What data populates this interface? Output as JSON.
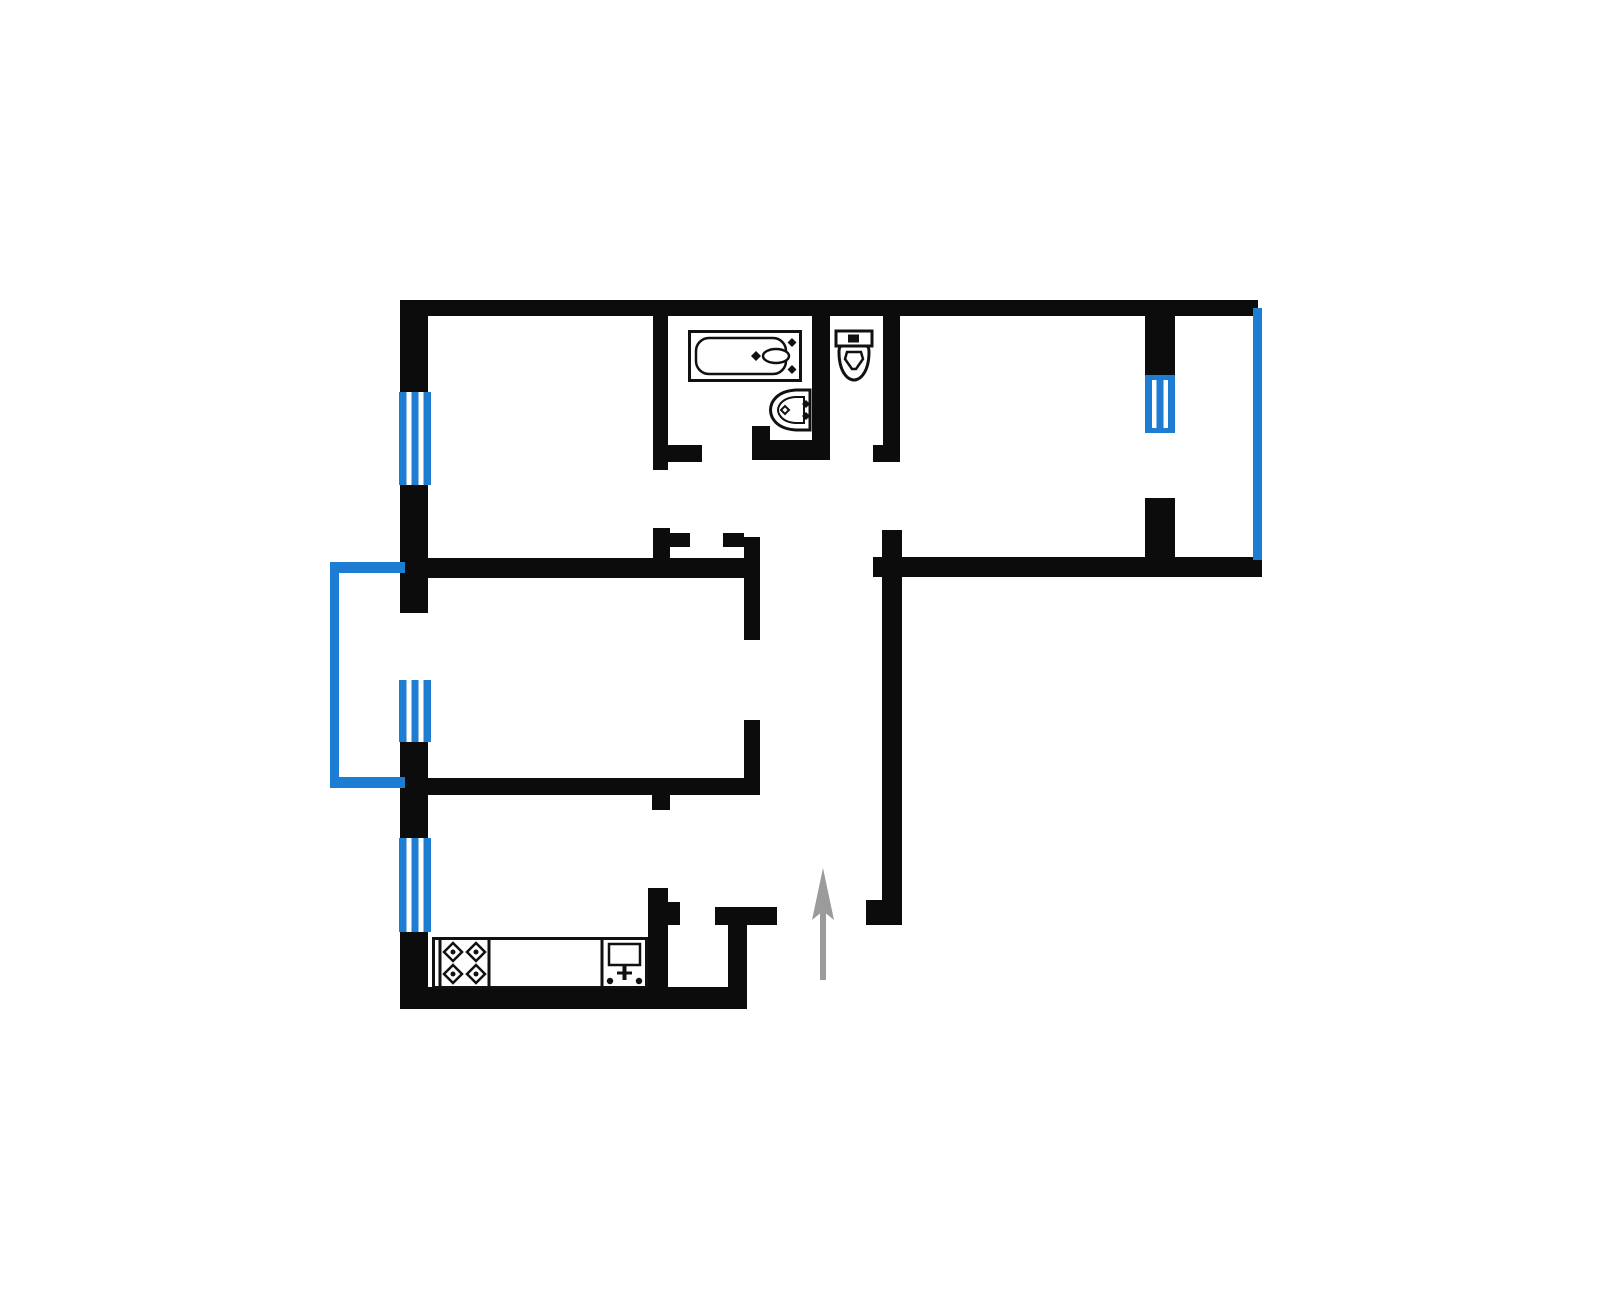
{
  "diagram": {
    "type": "apartment-floor-plan",
    "canvas": {
      "width": 1600,
      "height": 1303
    },
    "colors": {
      "background": "#ffffff",
      "wall": "#0c0c0c",
      "window": "#1d7dd2",
      "arrow": "#9b9b9b",
      "fixture": "#111111"
    },
    "walls": [
      {
        "name": "top-wall",
        "x": 400,
        "y": 300,
        "w": 858,
        "h": 16
      },
      {
        "name": "left-wall-top",
        "x": 400,
        "y": 300,
        "w": 28,
        "h": 92
      },
      {
        "name": "left-wall-mid-1",
        "x": 400,
        "y": 485,
        "w": 28,
        "h": 128
      },
      {
        "name": "left-wall-mid-2",
        "x": 400,
        "y": 742,
        "w": 28,
        "h": 96
      },
      {
        "name": "left-wall-bottom",
        "x": 400,
        "y": 932,
        "w": 28,
        "h": 77
      },
      {
        "name": "kitchen-south-wall",
        "x": 400,
        "y": 987,
        "w": 347,
        "h": 22
      },
      {
        "name": "right-wing-south-wall",
        "x": 873,
        "y": 557,
        "w": 389,
        "h": 20
      },
      {
        "name": "balcony-partition-upper",
        "x": 1145,
        "y": 315,
        "w": 30,
        "h": 60
      },
      {
        "name": "balcony-partition-lower",
        "x": 1145,
        "y": 498,
        "w": 30,
        "h": 61
      },
      {
        "name": "bathroom-west-wall",
        "x": 653,
        "y": 315,
        "w": 15,
        "h": 155
      },
      {
        "name": "bathroom-west-wall-foot",
        "x": 667,
        "y": 445,
        "w": 35,
        "h": 17
      },
      {
        "name": "bathroom-toilet-partition",
        "x": 812,
        "y": 315,
        "w": 18,
        "h": 145
      },
      {
        "name": "bathroom-south-wall",
        "x": 752,
        "y": 440,
        "w": 78,
        "h": 20
      },
      {
        "name": "bathroom-door-jamb",
        "x": 752,
        "y": 426,
        "w": 18,
        "h": 16
      },
      {
        "name": "toilet-east-wall",
        "x": 883,
        "y": 315,
        "w": 17,
        "h": 147
      },
      {
        "name": "toilet-east-wall-foot",
        "x": 873,
        "y": 445,
        "w": 27,
        "h": 17
      },
      {
        "name": "hall-central-wall",
        "x": 882,
        "y": 530,
        "w": 20,
        "h": 395
      },
      {
        "name": "hall-central-wall-foot",
        "x": 866,
        "y": 900,
        "w": 36,
        "h": 25
      },
      {
        "name": "living-room-north-wall",
        "x": 428,
        "y": 558,
        "w": 332,
        "h": 20
      },
      {
        "name": "living-room-east-wall-upper",
        "x": 744,
        "y": 537,
        "w": 16,
        "h": 103
      },
      {
        "name": "bedroom-door-jamb-stub",
        "x": 653,
        "y": 528,
        "w": 17,
        "h": 32
      },
      {
        "name": "bedroom-door-jamb-left",
        "x": 670,
        "y": 533,
        "w": 20,
        "h": 14
      },
      {
        "name": "bedroom-door-jamb-right",
        "x": 723,
        "y": 533,
        "w": 21,
        "h": 14
      },
      {
        "name": "living-room-south-wall",
        "x": 428,
        "y": 778,
        "w": 332,
        "h": 17
      },
      {
        "name": "living-room-east-wall-lower",
        "x": 744,
        "y": 720,
        "w": 16,
        "h": 75
      },
      {
        "name": "kitchen-door-jamb",
        "x": 652,
        "y": 795,
        "w": 18,
        "h": 15
      },
      {
        "name": "kitchen-east-wall",
        "x": 648,
        "y": 888,
        "w": 20,
        "h": 121
      },
      {
        "name": "closet-door-jamb",
        "x": 668,
        "y": 902,
        "w": 12,
        "h": 23
      },
      {
        "name": "closet-north-wall",
        "x": 715,
        "y": 907,
        "w": 62,
        "h": 18
      },
      {
        "name": "closet-east-wall",
        "x": 728,
        "y": 925,
        "w": 19,
        "h": 80
      }
    ],
    "windows": [
      {
        "name": "bedroom-window",
        "x": 399,
        "y": 392,
        "w": 32,
        "h": 93,
        "capped": false
      },
      {
        "name": "living-room-balcony-window",
        "x": 399,
        "y": 680,
        "w": 32,
        "h": 62,
        "capped": false
      },
      {
        "name": "kitchen-window",
        "x": 399,
        "y": 838,
        "w": 32,
        "h": 94,
        "capped": false
      },
      {
        "name": "right-room-balcony-window",
        "x": 1145,
        "y": 375,
        "w": 30,
        "h": 58,
        "capped": true
      }
    ],
    "glazing": [
      {
        "name": "left-balcony-outline-west",
        "x": 330,
        "y": 562,
        "w": 9,
        "h": 226
      },
      {
        "name": "left-balcony-outline-north",
        "x": 330,
        "y": 562,
        "w": 75,
        "h": 11
      },
      {
        "name": "left-balcony-outline-south",
        "x": 330,
        "y": 777,
        "w": 75,
        "h": 11
      },
      {
        "name": "right-balcony-glazing-line",
        "x": 1253,
        "y": 308,
        "w": 9,
        "h": 252
      }
    ],
    "fixtures": {
      "bathtub": {
        "x": 688,
        "y": 330,
        "w": 114,
        "h": 52
      },
      "bathroom_sink": {
        "x": 768,
        "y": 388,
        "w": 45,
        "h": 44
      },
      "toilet": {
        "x": 834,
        "y": 329,
        "w": 40,
        "h": 61
      },
      "kitchen_counter": {
        "x": 432,
        "y": 937,
        "w": 216,
        "h": 52
      },
      "entrance_arrow": {
        "x": 808,
        "y": 868,
        "w": 30,
        "h": 112
      }
    }
  }
}
